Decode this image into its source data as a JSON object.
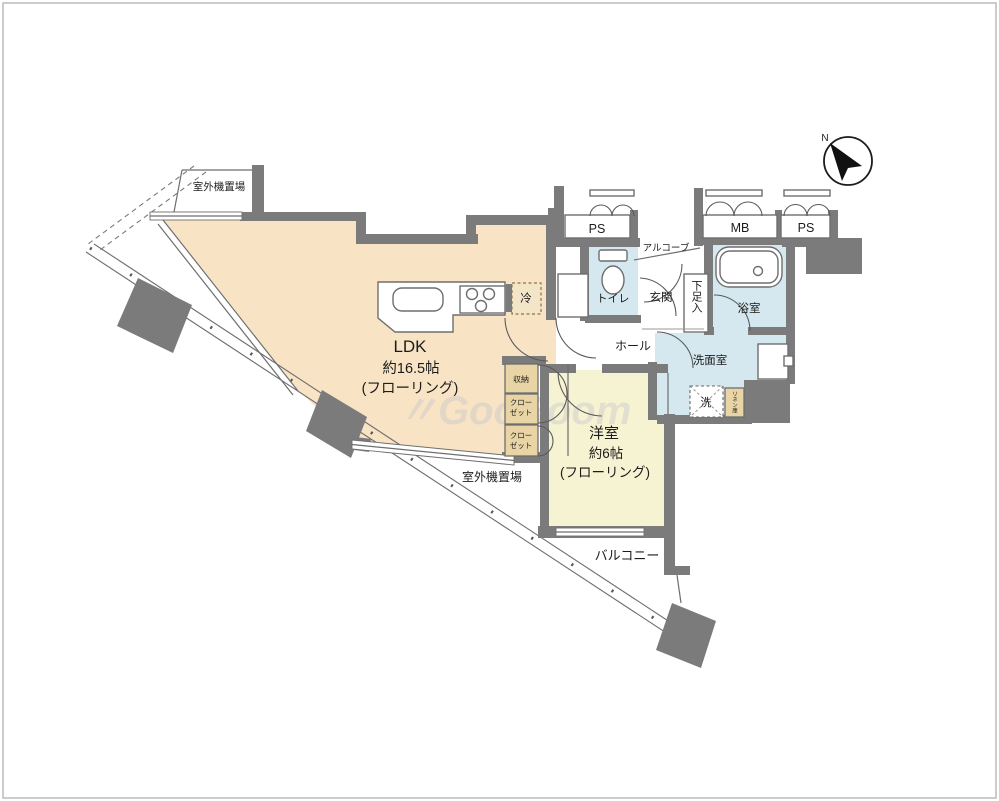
{
  "title": "1LDK floor plan",
  "watermark": "〃GooRoom",
  "compass": {
    "north_label": "N"
  },
  "colors": {
    "wall": "#7b7b7b",
    "ldk_floor": "#f8e4c5",
    "bedroom_floor": "#f6f3d3",
    "wet_area_floor": "#d5e8ef",
    "storage_fill": "#e9d4a5",
    "line": "#5a5a5a"
  },
  "rooms": {
    "ldk": {
      "name": "LDK",
      "size": "約16.5帖",
      "floor_type": "(フローリング)"
    },
    "bedroom": {
      "name": "洋室",
      "size": "約6帖",
      "floor_type": "(フローリング)"
    },
    "balcony": {
      "name": "バルコニー"
    },
    "hall": {
      "name": "ホール"
    },
    "entrance": {
      "name": "玄関"
    },
    "alcove": {
      "name": "アルコーブ"
    },
    "toilet": {
      "name": "トイレ"
    },
    "bathroom": {
      "name": "浴室"
    },
    "washroom": {
      "name": "洗面室"
    }
  },
  "labels": {
    "outdoor_unit_top": "室外機置場",
    "outdoor_unit_mid": "室外機置場",
    "ps_left": "PS",
    "mb": "MB",
    "ps_right": "PS",
    "shoe_cabinet": "下足入",
    "refrigerator": "冷",
    "washer": "洗",
    "linen_cabinet": "リネン庫",
    "storage": "収納",
    "closet1_line1": "クロー",
    "closet1_line2": "ゼット",
    "closet2_line1": "クロー",
    "closet2_line2": "ゼット"
  }
}
